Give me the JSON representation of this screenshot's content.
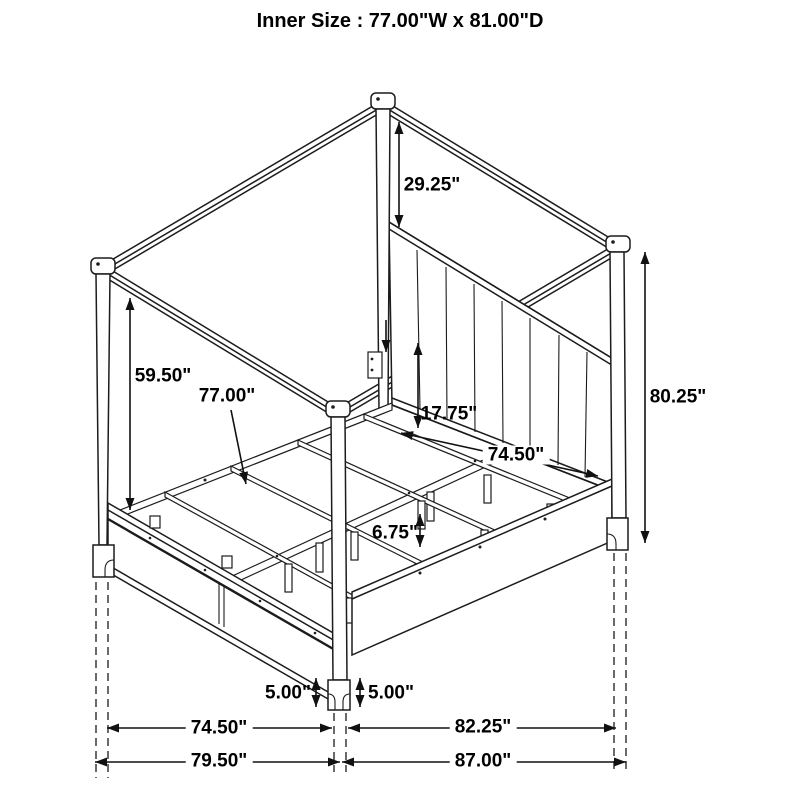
{
  "title": "Inner Size : 77.00\"W x 81.00\"D",
  "dimensions": {
    "canopy_to_headboard": "29.25\"",
    "canopy_to_footboard": "59.50\"",
    "slat_width": "77.00\"",
    "side_rail_height": "17.75\"",
    "inner_rail_depth": "74.50\"",
    "post_total_height": "80.25\"",
    "slat_leg_height": "6.75\"",
    "foot_height_left": "5.00\"",
    "foot_height_right": "5.00\"",
    "footboard_span_inner": "74.50\"",
    "headboard_span_inner": "82.25\"",
    "footboard_span_outer": "79.50\"",
    "headboard_span_outer": "87.00\""
  }
}
